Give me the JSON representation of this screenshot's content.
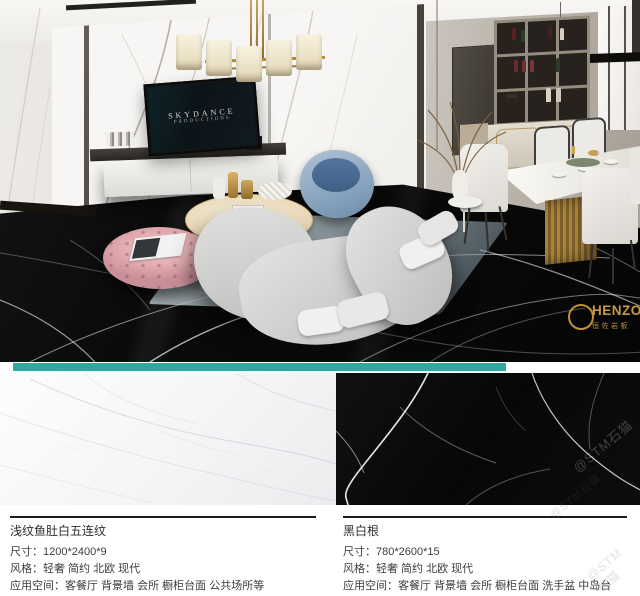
{
  "colors": {
    "divider_teal": "#2EA8A1",
    "gold_accent": "#C9993F",
    "floor_black": "#0A0A0A",
    "text_dark": "#3C3C3C"
  },
  "scene": {
    "tv_brand": "SKYDANCE",
    "tv_sub": "PRODUCTIONS",
    "logo_text": "HENZO",
    "logo_sub": "恒佐岩板",
    "watermark": "@STM石猫"
  },
  "products": [
    {
      "name": "浅纹鱼肚白五连纹",
      "size_label": "尺寸：",
      "size_value": "1200*2400*9",
      "style_label": "风格：",
      "style_value": "轻奢 简约 北欧 现代",
      "space_label": "应用空间：",
      "space_value": "客餐厅 背景墙 会所 橱柜台面 公共场所等"
    },
    {
      "name": "黑白根",
      "size_label": "尺寸：",
      "size_value": "780*2600*15",
      "style_label": "风格：",
      "style_value": "轻奢 简约 北欧 现代",
      "space_label": "应用空间：",
      "space_value": "客餐厅 背景墙 会所 橱柜台面 洗手盆 中岛台"
    }
  ]
}
